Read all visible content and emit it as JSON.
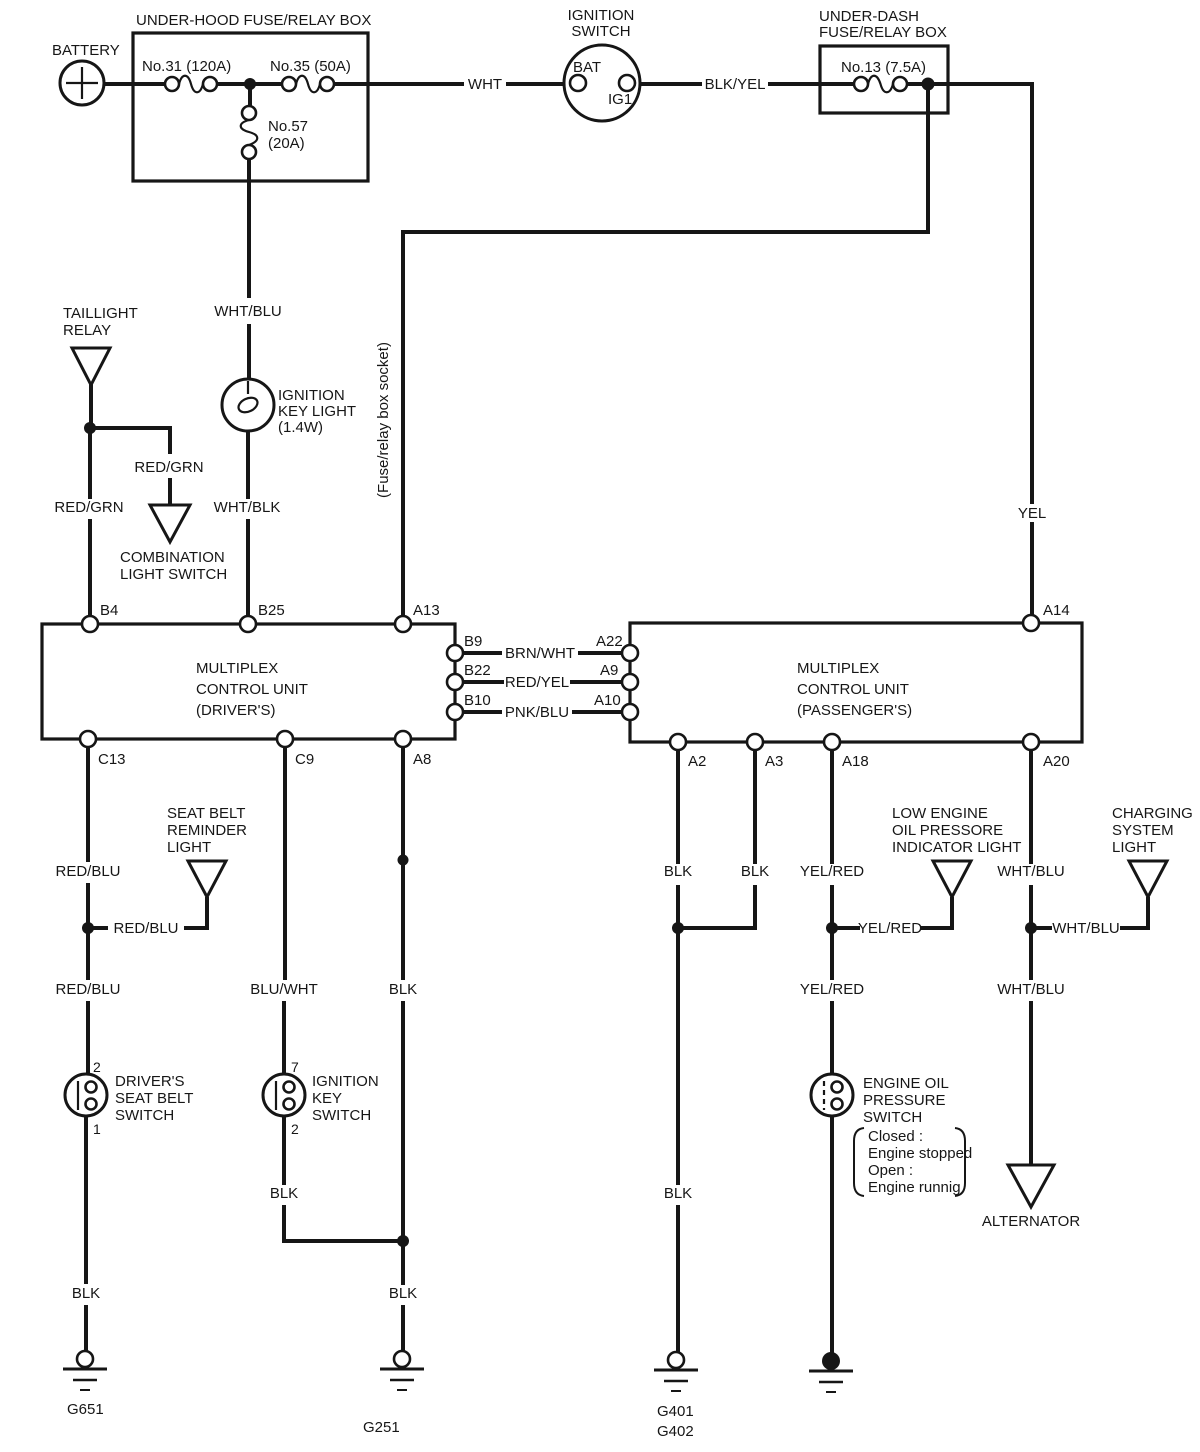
{
  "page": {
    "background": "#ffffff",
    "ink": "#161616"
  },
  "battery": {
    "label": "BATTERY"
  },
  "underhood_box": {
    "title": "UNDER-HOOD FUSE/RELAY BOX",
    "fuse31": "No.31 (120A)",
    "fuse35": "No.35 (50A)",
    "fuse57": [
      "No.57",
      "(20A)"
    ]
  },
  "ignition_switch": {
    "title": [
      "IGNITION",
      "SWITCH"
    ],
    "bat": "BAT",
    "ig1": "IG1"
  },
  "underdash_box": {
    "title": [
      "UNDER-DASH",
      "FUSE/RELAY BOX"
    ],
    "fuse13": "No.13 (7.5A)"
  },
  "socket_note": "(Fuse/relay box socket)",
  "taillight_relay": {
    "title": [
      "TAILLIGHT",
      "RELAY"
    ]
  },
  "combination_light_switch": {
    "title": [
      "COMBINATION",
      "LIGHT SWITCH"
    ]
  },
  "ignition_key_light": {
    "title": [
      "IGNITION",
      "KEY LIGHT",
      "(1.4W)"
    ]
  },
  "mcu_driver": {
    "title": [
      "MULTIPLEX",
      "CONTROL UNIT",
      "(DRIVER'S)"
    ],
    "pins": {
      "b4": "B4",
      "b25": "B25",
      "a13": "A13",
      "b9": "B9",
      "b22": "B22",
      "b10": "B10",
      "c13": "C13",
      "c9": "C9",
      "a8": "A8"
    }
  },
  "mcu_passenger": {
    "title": [
      "MULTIPLEX",
      "CONTROL UNIT",
      "(PASSENGER'S)"
    ],
    "pins": {
      "a14": "A14",
      "a22": "A22",
      "a9": "A9",
      "a10": "A10",
      "a2": "A2",
      "a3": "A3",
      "a18": "A18",
      "a20": "A20"
    }
  },
  "seat_belt_reminder_light": {
    "title": [
      "SEAT BELT",
      "REMINDER",
      "LIGHT"
    ]
  },
  "drivers_seat_belt_switch": {
    "title": [
      "DRIVER'S",
      "SEAT BELT",
      "SWITCH"
    ],
    "pin_top": "2",
    "pin_bottom": "1"
  },
  "ignition_key_switch": {
    "title": [
      "IGNITION",
      "KEY",
      "SWITCH"
    ],
    "pin_top": "7",
    "pin_bottom": "2"
  },
  "low_oil_light": {
    "title": [
      "LOW ENGINE",
      "OIL PRESSORE",
      "INDICATOR LIGHT"
    ]
  },
  "charging_light": {
    "title": [
      "CHARGING",
      "SYSTEM",
      "LIGHT"
    ]
  },
  "oil_pressure_switch": {
    "title": [
      "ENGINE OIL",
      "PRESSURE",
      "SWITCH"
    ],
    "note": [
      "Closed :",
      "Engine stopped",
      "Open :",
      "Engine runnig"
    ]
  },
  "alternator": {
    "label": "ALTERNATOR"
  },
  "grounds": {
    "g651": "G651",
    "g251": "G251",
    "g401": "G401",
    "g402": "G402"
  },
  "wires": {
    "wht": "WHT",
    "blk_yel": "BLK/YEL",
    "wht_blu": "WHT/BLU",
    "wht_blk": "WHT/BLK",
    "red_grn": "RED/GRN",
    "yel": "YEL",
    "brn_wht": "BRN/WHT",
    "red_yel": "RED/YEL",
    "pnk_blu": "PNK/BLU",
    "red_blu": "RED/BLU",
    "blu_wht": "BLU/WHT",
    "blk": "BLK",
    "yel_red": "YEL/RED"
  }
}
